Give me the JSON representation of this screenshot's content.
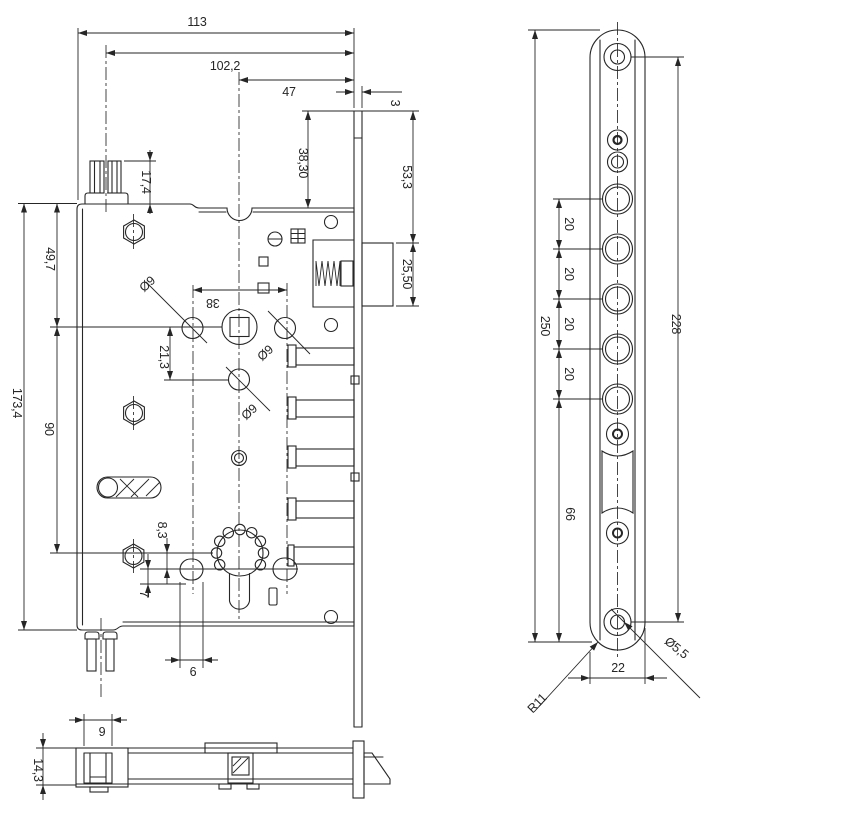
{
  "front_view": {
    "dim_total_width": "113",
    "dim_stud_to_faceplate": "102,2",
    "dim_backset": "47",
    "dim_faceplate_thickness": "3",
    "dim_plate_top_to_case": "38,30",
    "dim_plate_top_to_latch": "53,3",
    "dim_latch_height": "25,50",
    "dim_stud_height": "17,4",
    "dim_case_top_to_follower": "49,7",
    "dim_follower_to_cylinder": "90",
    "dim_case_height": "173,4",
    "dim_follower_to_hole": "21,3",
    "dim_hole_span": "38",
    "dim_hole_dia_left": "Ø9",
    "dim_hole_dia_right": "Ø9",
    "dim_hole_dia_bottom": "Ø9",
    "dim_cylinder_to_slot": "8,3",
    "dim_slot_drop": "7",
    "dim_slot_width": "6"
  },
  "faceplate_view": {
    "dim_plate_length": "250",
    "dim_screw_span": "228",
    "dim_bolt_pitch": [
      "20",
      "20",
      "20",
      "20"
    ],
    "dim_lower_span": "66",
    "dim_plate_width": "22",
    "dim_screw_hole_dia": "Ø5,5",
    "dim_corner_radius": "R11"
  },
  "side_view": {
    "dim_stud_width": "9",
    "dim_case_thickness": "14,3"
  },
  "style": {
    "line_color": "#262626",
    "background": "#ffffff"
  }
}
